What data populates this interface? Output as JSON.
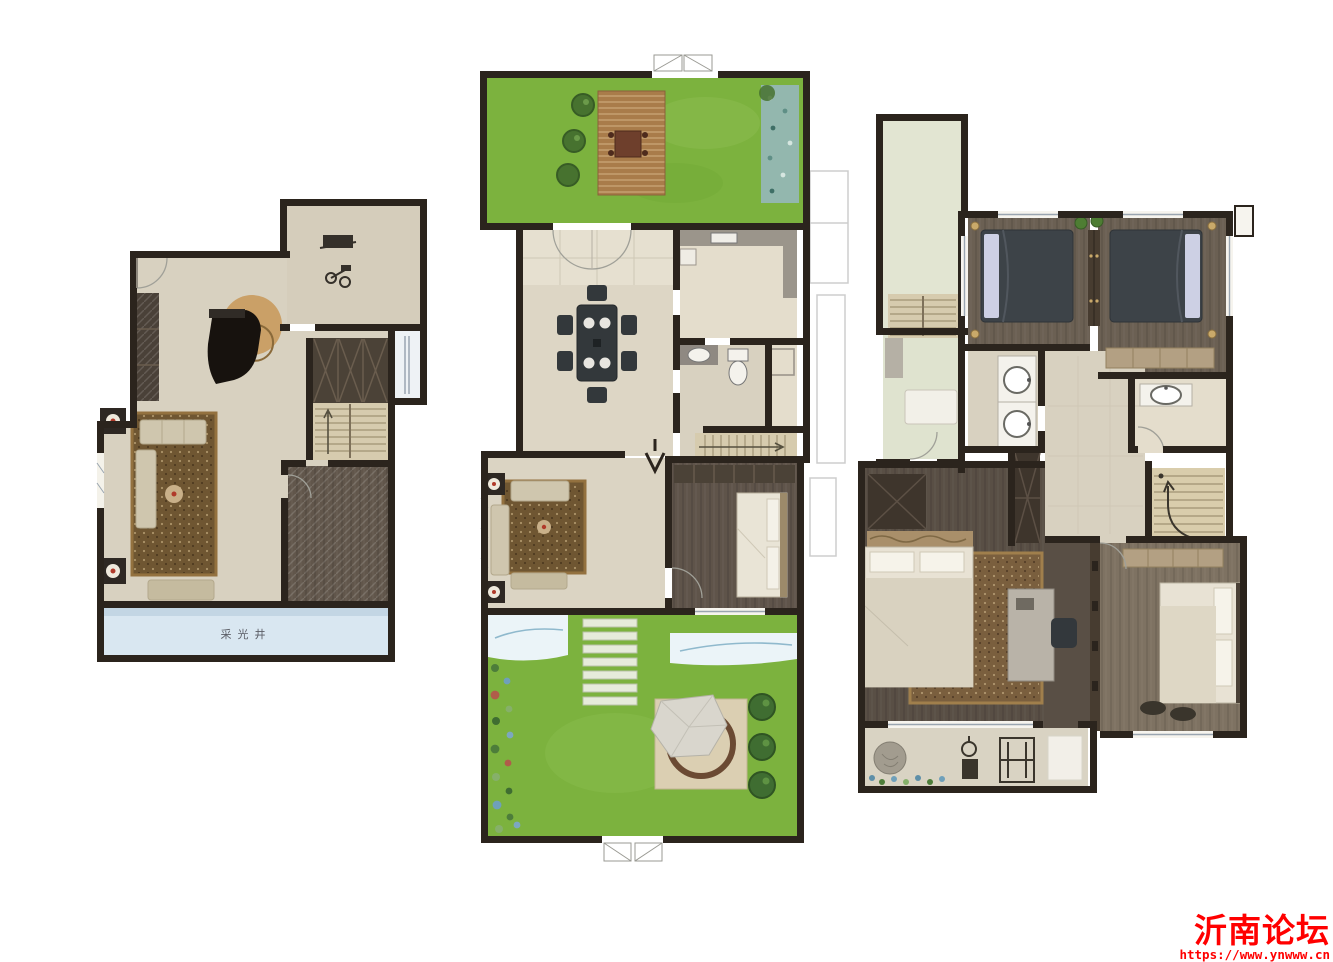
{
  "watermark": {
    "title": "沂南论坛",
    "url": "https://www.ynwww.cn",
    "color": "#ff0000"
  },
  "plans": {
    "basement": {
      "lightwell_label": "采光井"
    }
  },
  "palette": {
    "wall": "#2b241d",
    "floor_beige": "#d8d1c0",
    "floor_light": "#e4ddcc",
    "wood_dark": "#61564b",
    "wood_light": "#7e7262",
    "grass_green": "#7cb23e",
    "deck_brown": "#a97c4a",
    "water_blue": "#d9e7f1",
    "pebble_teal": "#93b7ae",
    "rug_brown": "#6f5632",
    "bed_slate": "#3d4348",
    "stair_tan": "#d6cbae",
    "tree_green": "#47722f",
    "lamp_gold": "#c9a96a",
    "watermark_red": "#ff0000"
  }
}
